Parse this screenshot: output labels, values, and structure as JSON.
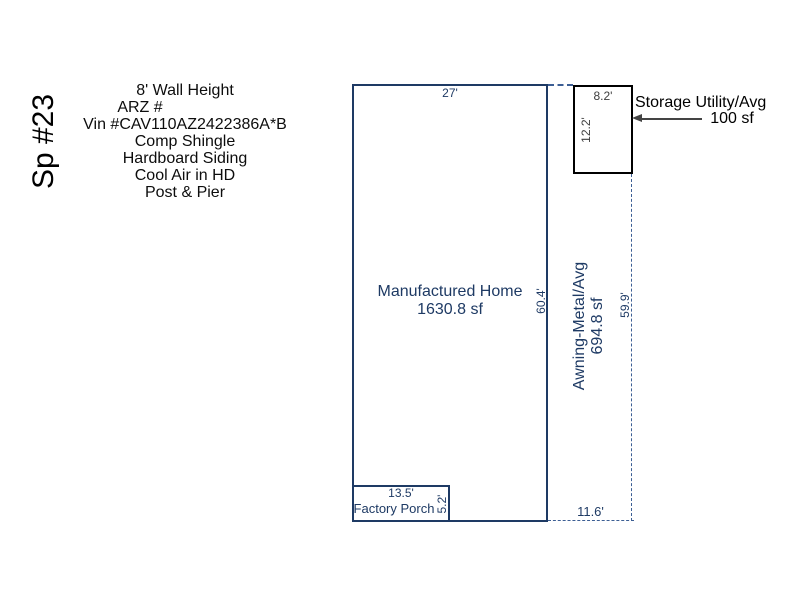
{
  "colors": {
    "sketch_line": "#1e3a64",
    "dash_line": "#3c5e94",
    "storage_line": "#000000",
    "storage_dim_text": "#3d3d3d",
    "annotation_text": "#000000",
    "arrow": "#444444",
    "background": "#ffffff"
  },
  "space_label": "Sp #23",
  "info_lines": [
    "8' Wall Height",
    "ARZ #",
    "Vin #CAV110AZ2422386A*B",
    "Comp Shingle",
    "Hardboard Siding",
    "Cool Air in HD",
    "Post & Pier"
  ],
  "home": {
    "name": "Manufactured Home",
    "area": "1630.8 sf",
    "width_dim": "27'",
    "height_dim": "60.4'"
  },
  "awning": {
    "name": "Awning-Metal/Avg",
    "area": "694.8 sf",
    "height_dim": "59.9'",
    "width_dim": "11.6'"
  },
  "storage": {
    "name": "Storage Utility/Avg",
    "area": "100 sf",
    "width_dim": "8.2'",
    "height_dim": "12.2'"
  },
  "porch": {
    "name": "Factory Porch",
    "width_dim": "13.5'",
    "height_dim": "5.2'"
  }
}
